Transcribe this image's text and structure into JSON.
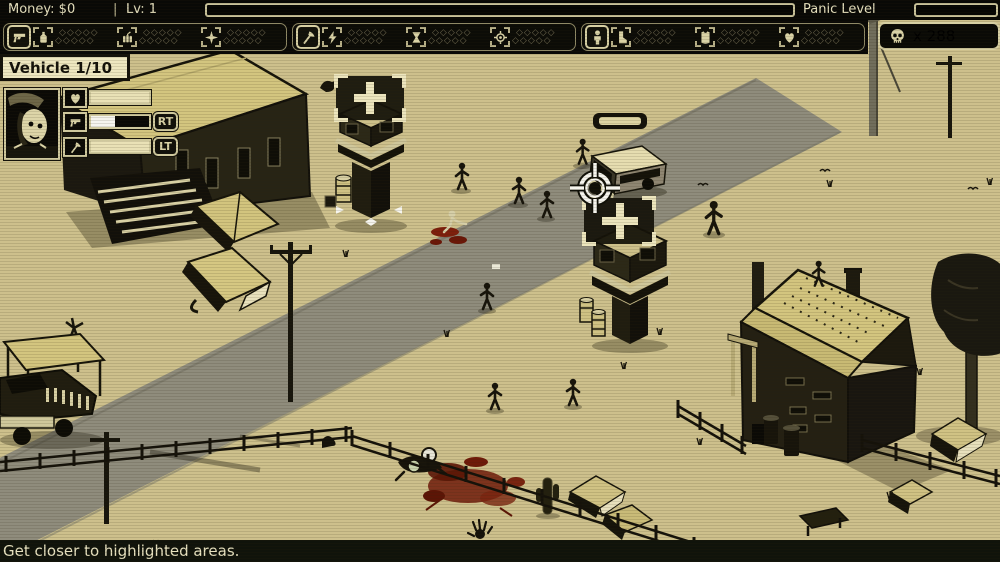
{
  "hud": {
    "money": "Money: $0",
    "separator": "|",
    "level": "Lv: 1",
    "panic_label": "Panic Level",
    "panic_left_fill_style": "width:0%",
    "panic_right_fill_style": "width:0%",
    "skull_count": "x 288"
  },
  "vehicle_panel": {
    "label": "Vehicle 1/10",
    "rt_label": "RT",
    "lt_label": "LT",
    "health_fill_style": "width:100%;background:#e9e1b6",
    "ranged_fill_style": "width:42%;background:#f5f4ee",
    "melee_fill_style": "width:100%;background:#e9e1b6"
  },
  "toolbar": {
    "pips_row": "◇◇◇◇◇",
    "groups": [
      {
        "slot_icon": "revolver-icon",
        "items": [
          "molotov-icon",
          "dynamite-icon",
          "spike-icon"
        ]
      },
      {
        "slot_icon": "axe-icon",
        "items": [
          "lightning-icon",
          "hourglass-icon",
          "target-icon"
        ]
      },
      {
        "slot_icon": "survivor-icon",
        "items": [
          "boot-icon",
          "armor-icon",
          "heart-icon"
        ]
      }
    ]
  },
  "message_bar": {
    "text": "Get closer to highlighted areas."
  },
  "scene": {
    "highlight_markers": 2,
    "vehicle_overhead_health": "full",
    "cursor": "crosshair"
  },
  "colors": {
    "sand": "#cdc08c",
    "road": "#8f8c7c",
    "hud_cream": "#e8e2c0",
    "hud_border": "#cfc89d",
    "roof_khaki": "#d3c57f",
    "dark": "#17140b",
    "blood": "#6e1a09",
    "white": "#f5f4ee"
  }
}
